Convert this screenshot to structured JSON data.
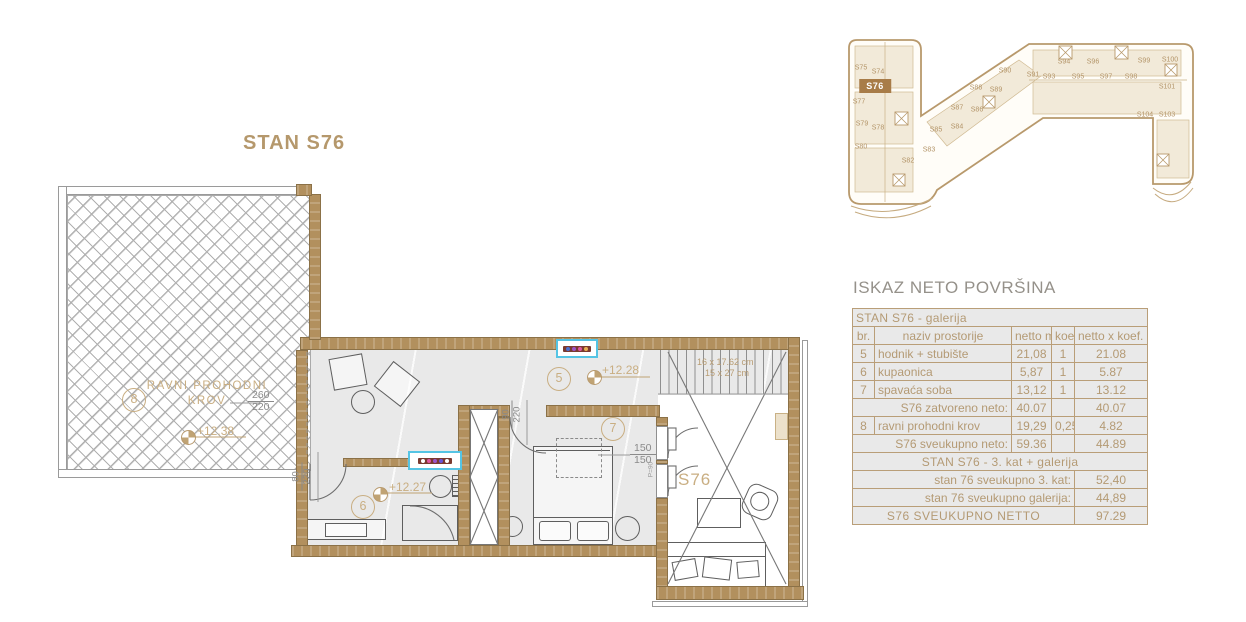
{
  "plan_title": "STAN S76",
  "floor_plan": {
    "terrace": {
      "room_number": "8",
      "label_line1": "RAVNI PROHODNI",
      "label_line2": "KROV",
      "level": "+12.38",
      "dim_top": "260",
      "dim_bottom": "220"
    },
    "hall": {
      "room_number": "5",
      "level": "+12.28"
    },
    "bathroom": {
      "room_number": "6",
      "level": "+12.27",
      "door_dim_top": "80",
      "door_dim_bottom": "220"
    },
    "bedroom": {
      "room_number": "7",
      "door_dim_top": "90",
      "door_dim_bottom": "220",
      "window_dim_top": "150",
      "window_dim_bottom": "150",
      "parapet_note": "P=90"
    },
    "void": {
      "unit_label": "S76"
    },
    "stairs": {
      "line1": "16 x 17.62 cm",
      "line2": "15 x 27 cm"
    }
  },
  "key_plan": {
    "highlighted": "S76",
    "highlight_pos": {
      "x": 40,
      "y": 70
    },
    "units": [
      {
        "id": "S75",
        "x": 26,
        "y": 52
      },
      {
        "id": "S74",
        "x": 43,
        "y": 56
      },
      {
        "id": "S77",
        "x": 24,
        "y": 86
      },
      {
        "id": "S79",
        "x": 27,
        "y": 108
      },
      {
        "id": "S78",
        "x": 43,
        "y": 112
      },
      {
        "id": "S80",
        "x": 26,
        "y": 131
      },
      {
        "id": "S82",
        "x": 73,
        "y": 145
      },
      {
        "id": "S83",
        "x": 94,
        "y": 134
      },
      {
        "id": "S85",
        "x": 101,
        "y": 114
      },
      {
        "id": "S84",
        "x": 122,
        "y": 111
      },
      {
        "id": "S87",
        "x": 122,
        "y": 92
      },
      {
        "id": "S86",
        "x": 142,
        "y": 94
      },
      {
        "id": "S88",
        "x": 141,
        "y": 72
      },
      {
        "id": "S89",
        "x": 161,
        "y": 74
      },
      {
        "id": "S90",
        "x": 170,
        "y": 55
      },
      {
        "id": "S91",
        "x": 198,
        "y": 59
      },
      {
        "id": "S93",
        "x": 214,
        "y": 61
      },
      {
        "id": "S94",
        "x": 229,
        "y": 46
      },
      {
        "id": "S95",
        "x": 243,
        "y": 61
      },
      {
        "id": "S96",
        "x": 258,
        "y": 46
      },
      {
        "id": "S97",
        "x": 271,
        "y": 61
      },
      {
        "id": "S98",
        "x": 296,
        "y": 61
      },
      {
        "id": "S99",
        "x": 309,
        "y": 45
      },
      {
        "id": "S100",
        "x": 335,
        "y": 44
      },
      {
        "id": "S101",
        "x": 332,
        "y": 71
      },
      {
        "id": "S104",
        "x": 310,
        "y": 99
      },
      {
        "id": "S103",
        "x": 332,
        "y": 99
      }
    ]
  },
  "area_table": {
    "title": "ISKAZ NETO POVRŠINA",
    "rows": [
      {
        "type": "section",
        "align": "l",
        "label": "STAN S76 - galerija"
      },
      {
        "type": "header",
        "cells": [
          "br.",
          "naziv prostorije",
          "netto m²",
          "koef.",
          "netto x koef. m²"
        ]
      },
      {
        "type": "data",
        "cells": [
          "5",
          "hodnik + stubište",
          "21,08",
          "1",
          "21.08"
        ]
      },
      {
        "type": "data",
        "cells": [
          "6",
          "kupaonica",
          "5,87",
          "1",
          "5.87"
        ]
      },
      {
        "type": "data",
        "cells": [
          "7",
          "spavaća soba",
          "13,12",
          "1",
          "13.12"
        ]
      },
      {
        "type": "subtotal",
        "label": "S76 zatvoreno neto:",
        "netto": "40.07",
        "koef": "",
        "result": "40.07"
      },
      {
        "type": "data",
        "cells": [
          "8",
          "ravni prohodni krov",
          "19,29",
          "0,25",
          "4.82"
        ]
      },
      {
        "type": "subtotal",
        "label": "S76 sveukupno neto:",
        "netto": "59.36",
        "koef": "",
        "result": "44.89"
      },
      {
        "type": "section",
        "align": "c",
        "label": "STAN S76 - 3. kat + galerija"
      },
      {
        "type": "wide",
        "label": "stan 76 sveukupno 3. kat:",
        "value": "52,40"
      },
      {
        "type": "wide",
        "label": "stan 76 sveukupno galerija:",
        "value": "44,89"
      },
      {
        "type": "grand",
        "label": "S76 SVEUKUPNO NETTO",
        "value": "97.29"
      }
    ]
  },
  "colors": {
    "wall": "#b2905e",
    "accent_text": "#c9ae82",
    "table_border": "#b99e78",
    "highlight_bg": "#a87c48"
  }
}
